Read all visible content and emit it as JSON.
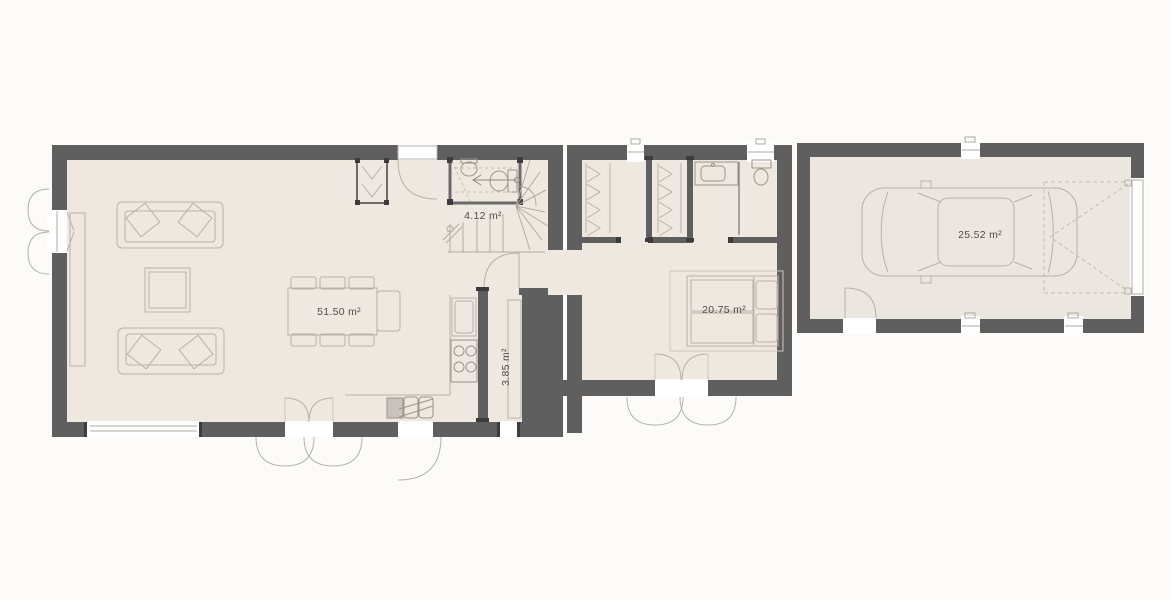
{
  "plan": {
    "title": "single-storey house floor plan",
    "rooms": [
      {
        "id": "living-room",
        "label": "51.50 m²"
      },
      {
        "id": "staircase-wc",
        "label": "4.12 m²"
      },
      {
        "id": "pantry",
        "label": "3.85 m²"
      },
      {
        "id": "bedroom",
        "label": "20.75 m²"
      },
      {
        "id": "garage",
        "label": "25.52 m²"
      }
    ]
  },
  "colors": {
    "wall": "#5f5f5f",
    "wall_dark": "#3c3c3c",
    "floor": "#efe8e1",
    "floor_garage": "#ece6e0",
    "line": "#b9b1a9",
    "line_soft": "#cdc6bf",
    "text": "#4c4c4c",
    "opening": "#ffffff",
    "background": "#fcfbfa"
  }
}
